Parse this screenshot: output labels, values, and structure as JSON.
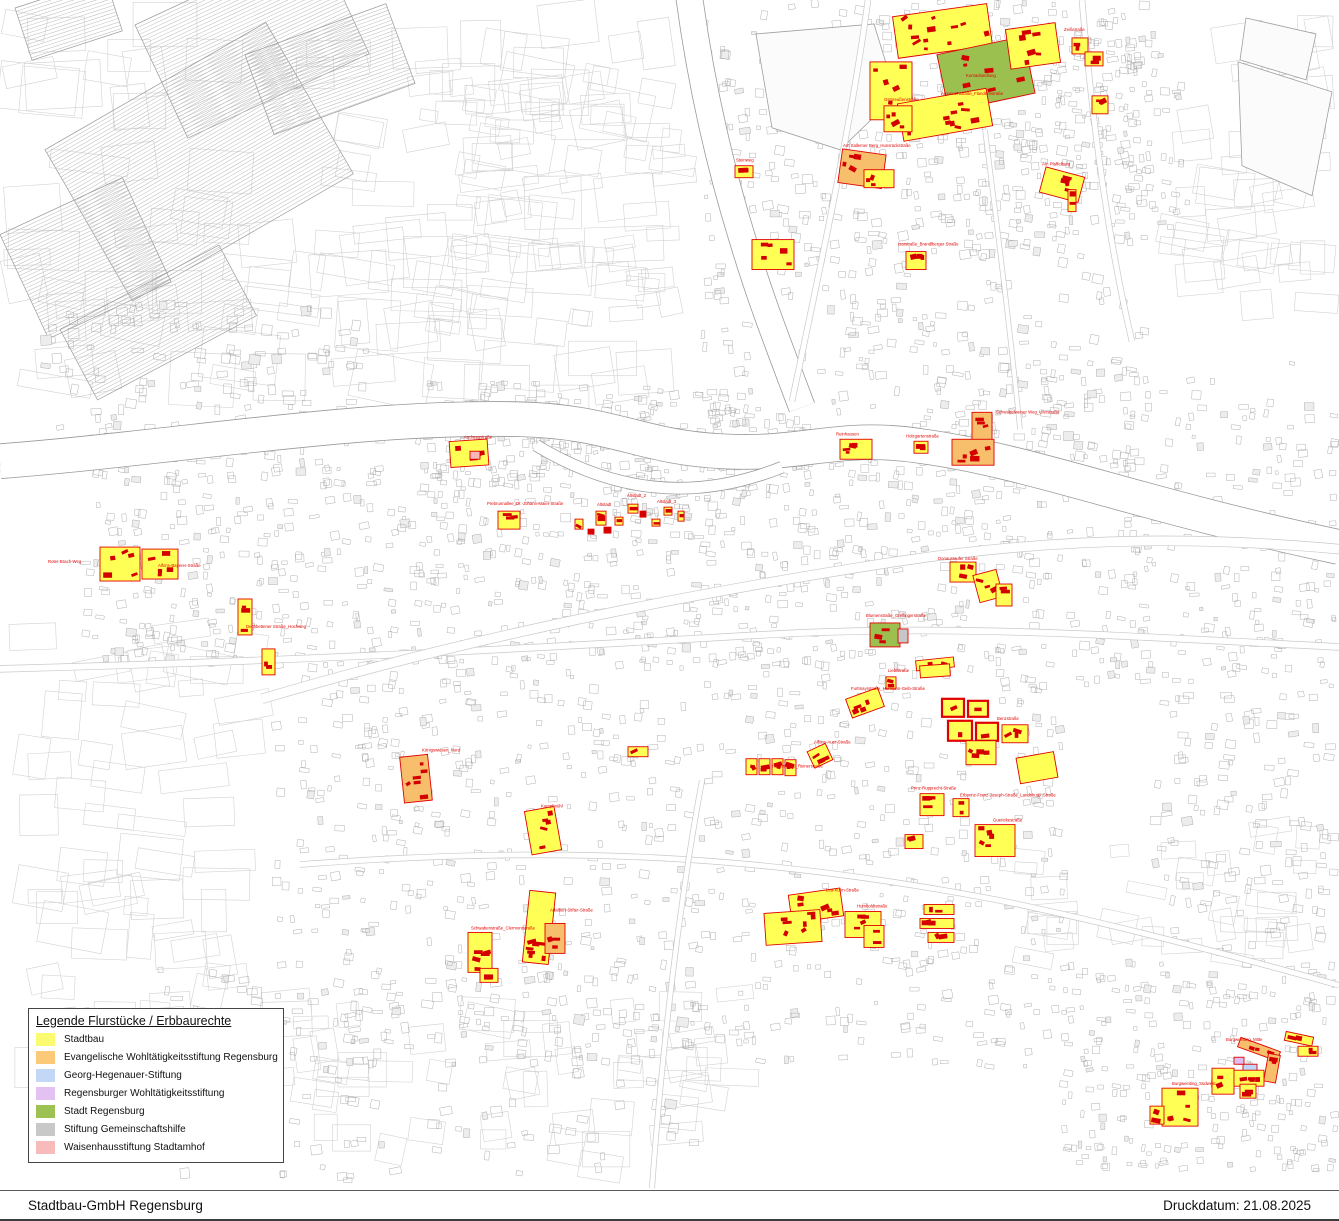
{
  "legend": {
    "title": "Legende Flurstücke / Erbbaurechte",
    "items": [
      {
        "label": "Stadtbau",
        "color": "#FBFB72"
      },
      {
        "label": "Evangelische Wohltätigkeitsstiftung Regensburg",
        "color": "#FBC978"
      },
      {
        "label": "Georg-Hegenauer-Stiftung",
        "color": "#C3D7F7"
      },
      {
        "label": "Regensburger Wohltätigkeitsstiftung",
        "color": "#E3C1F2"
      },
      {
        "label": "Stadt Regensburg",
        "color": "#9DC153"
      },
      {
        "label": "Stiftung Gemeinschaftshilfe",
        "color": "#C8C8C8"
      },
      {
        "label": "Waisenhausstiftung Stadtamhof",
        "color": "#F8BBBB"
      }
    ]
  },
  "footer": {
    "company": "Stadtbau-GmbH Regensburg",
    "print_date_label": "Druckdatum: 21.08.2025"
  },
  "map": {
    "colors": {
      "stadtbau": "#FFFF55",
      "evangelische": "#F7BE6B",
      "georg_hegenauer": "#BFD6F8",
      "regensburger_wohltaetigkeit": "#DFBFF2",
      "stadt_regensburg": "#9CC050",
      "gemeinschaftshilfe": "#C6C6C6",
      "waisenhaus": "#F8B8B8",
      "parcel_outline": "#E10000",
      "building": "#D40000",
      "label_text": "#E10000",
      "base_line": "#ABABAB"
    },
    "clusters": [
      [
        "k1",
        895,
        10,
        95,
        42,
        -8,
        "y",
        12
      ],
      [
        "k2",
        870,
        62,
        42,
        58,
        0,
        "y",
        6
      ],
      [
        "k3",
        942,
        45,
        88,
        58,
        -12,
        "g",
        9
      ],
      [
        "k4",
        1008,
        26,
        50,
        40,
        -8,
        "y",
        6
      ],
      [
        "k5",
        1072,
        38,
        16,
        16,
        0,
        "y",
        2
      ],
      [
        "k6",
        900,
        96,
        90,
        38,
        -10,
        "y",
        9
      ],
      [
        "k7",
        884,
        106,
        28,
        26,
        0,
        "y",
        4
      ],
      [
        "k8",
        1085,
        52,
        18,
        14,
        0,
        "y",
        3
      ],
      [
        "k9",
        1092,
        96,
        16,
        18,
        0,
        "y",
        3
      ],
      [
        "s1",
        840,
        152,
        44,
        34,
        8,
        "o",
        5
      ],
      [
        "s2",
        864,
        170,
        30,
        18,
        0,
        "y",
        3
      ],
      [
        "s3",
        1042,
        172,
        40,
        26,
        15,
        "y",
        4
      ],
      [
        "s4",
        1068,
        190,
        8,
        22,
        0,
        "y",
        2
      ],
      [
        "s5",
        906,
        252,
        20,
        18,
        0,
        "y",
        3
      ],
      [
        "s6",
        752,
        240,
        42,
        30,
        0,
        "y",
        5
      ],
      [
        "s7",
        735,
        166,
        18,
        12,
        0,
        "y",
        2
      ],
      [
        "r1",
        840,
        440,
        32,
        20,
        0,
        "y",
        4
      ],
      [
        "r2",
        972,
        413,
        20,
        28,
        0,
        "o",
        3
      ],
      [
        "r3",
        952,
        440,
        42,
        26,
        0,
        "o",
        5
      ],
      [
        "r4",
        914,
        442,
        14,
        12,
        0,
        "y",
        2
      ],
      [
        "r5",
        950,
        563,
        26,
        20,
        0,
        "y",
        3
      ],
      [
        "r6",
        976,
        573,
        24,
        28,
        -15,
        "y",
        3
      ],
      [
        "r7",
        996,
        585,
        16,
        22,
        0,
        "y",
        2
      ],
      [
        "a1",
        450,
        441,
        38,
        26,
        -4,
        "y",
        5
      ],
      [
        "a2",
        470,
        452,
        10,
        8,
        0,
        "pk",
        0
      ],
      [
        "w1",
        100,
        548,
        40,
        34,
        0,
        "y",
        5
      ],
      [
        "w2",
        142,
        550,
        36,
        30,
        0,
        "y",
        5
      ],
      [
        "w3",
        238,
        600,
        14,
        36,
        0,
        "y",
        3
      ],
      [
        "w4",
        262,
        650,
        13,
        26,
        0,
        "y",
        2
      ],
      [
        "c1",
        498,
        512,
        22,
        18,
        0,
        "y",
        3
      ],
      [
        "d1",
        575,
        520,
        8,
        10,
        0,
        "y",
        1
      ],
      [
        "d2",
        596,
        512,
        10,
        14,
        0,
        "y",
        2
      ],
      [
        "d3",
        615,
        518,
        8,
        8,
        0,
        "y",
        1
      ],
      [
        "d4",
        628,
        505,
        10,
        9,
        0,
        "y",
        1
      ],
      [
        "d5",
        640,
        512,
        6,
        6,
        0,
        "r",
        0
      ],
      [
        "d6",
        652,
        520,
        8,
        7,
        0,
        "y",
        1
      ],
      [
        "d7",
        664,
        508,
        8,
        8,
        0,
        "y",
        1
      ],
      [
        "d8",
        678,
        512,
        6,
        10,
        0,
        "y",
        1
      ],
      [
        "d9",
        604,
        528,
        7,
        6,
        0,
        "r",
        0
      ],
      [
        "d10",
        588,
        530,
        6,
        5,
        0,
        "r",
        0
      ],
      [
        "e1",
        870,
        624,
        30,
        24,
        0,
        "g",
        3
      ],
      [
        "e2",
        898,
        630,
        10,
        14,
        0,
        "gr",
        0
      ],
      [
        "e3",
        916,
        660,
        38,
        10,
        -6,
        "y",
        2
      ],
      [
        "g1",
        628,
        748,
        20,
        10,
        0,
        "y",
        1
      ],
      [
        "g2",
        746,
        760,
        11,
        16,
        0,
        "y",
        2
      ],
      [
        "g3",
        759,
        760,
        11,
        16,
        0,
        "y",
        2
      ],
      [
        "g4",
        772,
        760,
        11,
        16,
        0,
        "y",
        2
      ],
      [
        "g5",
        785,
        761,
        11,
        16,
        0,
        "y",
        2
      ],
      [
        "g6",
        810,
        748,
        20,
        18,
        -25,
        "y",
        3
      ],
      [
        "g7",
        920,
        666,
        30,
        12,
        -4,
        "y",
        0
      ],
      [
        "g8",
        848,
        694,
        34,
        20,
        -20,
        "y",
        4
      ],
      [
        "g9",
        886,
        678,
        10,
        12,
        0,
        "y",
        2
      ],
      [
        "g10",
        942,
        700,
        22,
        18,
        0,
        "y",
        1,
        "T"
      ],
      [
        "g11",
        968,
        702,
        20,
        16,
        0,
        "y",
        1,
        "T"
      ],
      [
        "g12",
        948,
        722,
        24,
        20,
        0,
        "y",
        1,
        "T"
      ],
      [
        "g13",
        976,
        724,
        22,
        18,
        0,
        "y",
        1,
        "T"
      ],
      [
        "g14",
        1002,
        726,
        26,
        18,
        0,
        "y",
        3
      ],
      [
        "g15",
        966,
        742,
        30,
        24,
        0,
        "y",
        4
      ],
      [
        "g16",
        1018,
        756,
        38,
        26,
        -10,
        "y",
        0
      ],
      [
        "g17",
        920,
        795,
        24,
        22,
        0,
        "y",
        4
      ],
      [
        "g18",
        953,
        800,
        16,
        18,
        0,
        "y",
        2
      ],
      [
        "g19",
        975,
        826,
        40,
        32,
        0,
        "y",
        5
      ],
      [
        "g20",
        905,
        836,
        18,
        14,
        0,
        "y",
        2
      ],
      [
        "q1",
        402,
        757,
        28,
        46,
        -6,
        "o",
        6
      ],
      [
        "q2",
        528,
        810,
        30,
        44,
        -10,
        "y",
        6
      ],
      [
        "q3",
        526,
        893,
        26,
        72,
        6,
        "y",
        8
      ],
      [
        "q4",
        545,
        925,
        20,
        30,
        0,
        "o",
        3
      ],
      [
        "q5",
        468,
        934,
        24,
        40,
        0,
        "y",
        5
      ],
      [
        "q6",
        480,
        970,
        18,
        14,
        0,
        "y",
        2
      ],
      [
        "h1",
        790,
        893,
        52,
        28,
        -8,
        "y",
        6
      ],
      [
        "h2",
        765,
        913,
        56,
        32,
        -4,
        "y",
        7
      ],
      [
        "h3",
        845,
        913,
        36,
        26,
        0,
        "y",
        4
      ],
      [
        "h4",
        864,
        927,
        20,
        22,
        0,
        "y",
        2
      ],
      [
        "u1",
        924,
        906,
        30,
        10,
        0,
        "y",
        2
      ],
      [
        "u2",
        920,
        920,
        34,
        10,
        0,
        "y",
        3
      ],
      [
        "u3",
        928,
        934,
        26,
        10,
        0,
        "y",
        2
      ],
      [
        "b1",
        1238,
        1046,
        42,
        10,
        20,
        "o",
        3
      ],
      [
        "b2",
        1266,
        1056,
        12,
        28,
        10,
        "o",
        2
      ],
      [
        "b3",
        1243,
        1066,
        14,
        9,
        0,
        "b",
        0
      ],
      [
        "b4",
        1234,
        1059,
        10,
        7,
        0,
        "p",
        0
      ],
      [
        "b5",
        1232,
        1072,
        32,
        16,
        0,
        "y",
        4
      ],
      [
        "b6",
        1285,
        1036,
        28,
        9,
        12,
        "y",
        2
      ],
      [
        "b7",
        1298,
        1048,
        20,
        10,
        0,
        "y",
        2
      ],
      [
        "b8",
        1162,
        1090,
        36,
        38,
        0,
        "y",
        5
      ],
      [
        "b9",
        1150,
        1108,
        14,
        18,
        0,
        "y",
        2
      ],
      [
        "b10",
        1212,
        1070,
        22,
        26,
        0,
        "y",
        3
      ],
      [
        "b11",
        1240,
        1086,
        16,
        14,
        0,
        "y",
        2
      ]
    ],
    "labels": [
      [
        966,
        77,
        "Konradsiedlung"
      ],
      [
        1064,
        31,
        "Zeißstraße"
      ],
      [
        941,
        95,
        "Argonnenstraße_Flandernstraße"
      ],
      [
        884,
        101,
        "Ostpreußenstraße"
      ],
      [
        843,
        147,
        "Am Sallerner Berg_Hunsrückstraße"
      ],
      [
        1042,
        166,
        "Am Pfaffelberg"
      ],
      [
        898,
        246,
        "Isarstraße_Brandlberger Straße"
      ],
      [
        736,
        162,
        "Steinweg"
      ],
      [
        836,
        436,
        "Reinhausen"
      ],
      [
        996,
        414,
        "Schwabelweiser Weg_Uferstraße"
      ],
      [
        906,
        438,
        "Holzgartenstraße"
      ],
      [
        464,
        439,
        "Andreasstraße"
      ],
      [
        48,
        564,
        "Roter-Brach-Weg"
      ],
      [
        158,
        568,
        "Alfons-Bayerer-Straße"
      ],
      [
        246,
        629,
        "Dechbettener Straße_Hochweg"
      ],
      [
        487,
        506,
        "Prebrunnallee_Dr.-Johann-Maier-Straße"
      ],
      [
        597,
        507,
        "Altstadt"
      ],
      [
        627,
        498,
        "Altstadt_2"
      ],
      [
        657,
        504,
        "Altstadt_3"
      ],
      [
        938,
        561,
        "Donaustaufer Straße"
      ],
      [
        866,
        618,
        "Blumenstraße_Greflingerstraße"
      ],
      [
        772,
        769,
        "Hayerstraße_Reinerstraße"
      ],
      [
        814,
        745,
        "Alfons-Auer-Straße"
      ],
      [
        851,
        691,
        "Furtmayrstraße_Hermann-Geib-Straße"
      ],
      [
        888,
        673,
        "Lieblstraße"
      ],
      [
        997,
        721,
        "Benzstraße"
      ],
      [
        911,
        791,
        "Prinz-Rupprecht-Straße"
      ],
      [
        960,
        798,
        "Erbprinz-Franz-Joseph-Straße_Landshuter Straße"
      ],
      [
        993,
        823,
        "Guerickestraße"
      ],
      [
        422,
        753,
        "Königswiesen_Nord"
      ],
      [
        541,
        809,
        "Kumpfmühl"
      ],
      [
        550,
        913,
        "Adalbert-Stifter-Straße"
      ],
      [
        471,
        931,
        "Schwabenstraße_Clermontstraße"
      ],
      [
        826,
        893,
        "Lea-Kuhn-Straße"
      ],
      [
        857,
        909,
        "Humboldtstraße"
      ],
      [
        1226,
        1043,
        "Burgweinting_Mitte"
      ],
      [
        1172,
        1087,
        "Burgweinting_Südwest"
      ]
    ]
  }
}
